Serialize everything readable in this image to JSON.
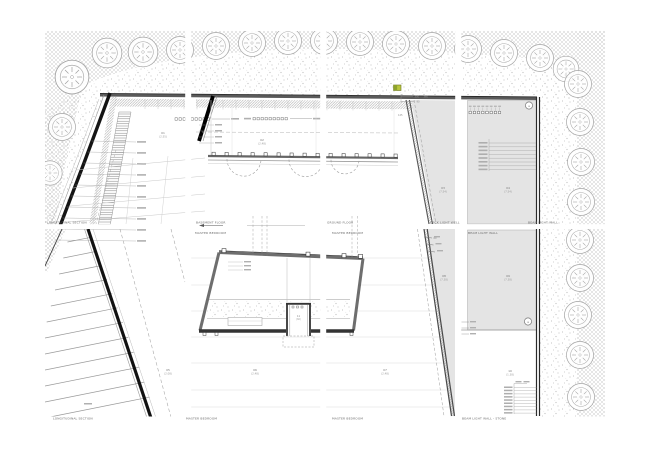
{
  "drawing": {
    "title": "site plan sheet grid (4x2 tiled architectural plan)",
    "colors": {
      "paper": "#ffffff",
      "hatch": "#c6c6c6",
      "stipple": "#b5b5b5",
      "wall_dark": "#141414",
      "wall_grey": "#6e6e6e",
      "fill_light": "#e4e4e4",
      "grid_line": "#d8d8d8",
      "accent_green": "#b9c63d",
      "caption_text": "#6b6b6b"
    },
    "captions": {
      "row1": [
        {
          "text": "LONGITUDINAL SECTION"
        },
        {
          "text": "BASEMENT FLOOR"
        },
        {
          "text": "GROUND FLOOR"
        },
        {
          "text": "DECK LIGHT WELL"
        },
        {
          "text": "BEAM LIGHT WALL"
        }
      ],
      "row2_top": [
        {
          "text": "MASTER BEDROOM"
        },
        {
          "text": "MASTER BEDROOM"
        },
        {
          "text": "BEAM LIGHT WALL"
        }
      ],
      "row2_bottom": [
        {
          "text": "LONGITUDINAL SECTION"
        },
        {
          "text": "MASTER BEDROOM"
        },
        {
          "text": "MASTER BEDROOM"
        },
        {
          "text": "BEAM LIGHT WALL - STONE"
        }
      ]
    },
    "area_labels": [
      {
        "id": "01",
        "value": "(2.55)"
      },
      {
        "id": "02",
        "value": "(2.48)"
      },
      {
        "id": "03",
        "value": "(7.54)"
      },
      {
        "id": "04",
        "value": "(7.54)"
      },
      {
        "id": "05",
        "value": "(2.08)"
      },
      {
        "id": "06",
        "value": "(2.48)"
      },
      {
        "id": "07",
        "value": "(2.48)"
      },
      {
        "id": "08",
        "value": "(7.38)"
      },
      {
        "id": "09",
        "value": "(7.38)"
      },
      {
        "id": "10",
        "value": "(1.38)"
      },
      {
        "id": "11",
        "value": "(60)"
      }
    ],
    "dim_texts": [
      {
        "t": "300"
      },
      {
        "t": "360"
      },
      {
        "t": "90"
      },
      {
        "t": "125"
      },
      {
        "t": "60"
      }
    ],
    "markers": {
      "detail_circles": [
        {
          "label": "a"
        },
        {
          "label": "a"
        }
      ],
      "green_highlight": {
        "color": "#b9c63d"
      }
    }
  }
}
